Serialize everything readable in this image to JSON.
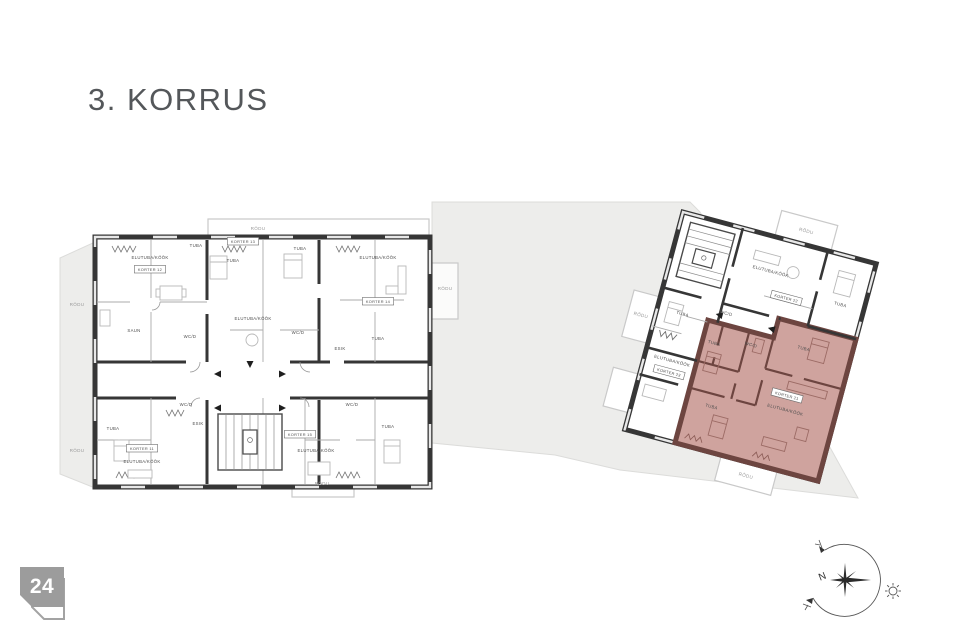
{
  "page": {
    "title": "3. KORRUS",
    "page_number": "24"
  },
  "legend": {
    "highlight_color": "#cb9b96",
    "highlight_wall": "#6d4540",
    "wall_color": "#363636",
    "site_color": "#ededeb",
    "badge_color": "#9c9c9c"
  },
  "left_building": {
    "labels": [
      {
        "t": "RÕDU",
        "x": 258,
        "y": 230,
        "s": "muted"
      },
      {
        "t": "RÕDU",
        "x": 77,
        "y": 306,
        "s": "muted"
      },
      {
        "t": "RÕDU",
        "x": 77,
        "y": 452,
        "s": "muted"
      },
      {
        "t": "RÕDU",
        "x": 445,
        "y": 290,
        "s": "muted"
      },
      {
        "t": "RÕDU",
        "x": 322,
        "y": 485,
        "s": "muted"
      },
      {
        "t": "ELUTUBA/KÖÖK",
        "x": 150,
        "y": 259,
        "s": "room"
      },
      {
        "t": "KORTER 12",
        "x": 150,
        "y": 271,
        "s": "unit"
      },
      {
        "t": "TUBA",
        "x": 196,
        "y": 247,
        "s": "room"
      },
      {
        "t": "TUBA",
        "x": 233,
        "y": 262,
        "s": "room"
      },
      {
        "t": "KORTER 13",
        "x": 243,
        "y": 243,
        "s": "unit"
      },
      {
        "t": "TUBA",
        "x": 300,
        "y": 250,
        "s": "room"
      },
      {
        "t": "ELUTUBA/KÖÖK",
        "x": 378,
        "y": 259,
        "s": "room"
      },
      {
        "t": "KORTER 14",
        "x": 378,
        "y": 303,
        "s": "unit"
      },
      {
        "t": "SAUN",
        "x": 134,
        "y": 332,
        "s": "room"
      },
      {
        "t": "WC/D",
        "x": 190,
        "y": 338,
        "s": "room"
      },
      {
        "t": "ELUTUBA/KÖÖK",
        "x": 253,
        "y": 320,
        "s": "room"
      },
      {
        "t": "WC/D",
        "x": 298,
        "y": 334,
        "s": "room"
      },
      {
        "t": "ESIK",
        "x": 340,
        "y": 350,
        "s": "room"
      },
      {
        "t": "TUBA",
        "x": 378,
        "y": 340,
        "s": "room"
      },
      {
        "t": "TUBA",
        "x": 113,
        "y": 430,
        "s": "room"
      },
      {
        "t": "KORTER 11",
        "x": 142,
        "y": 450,
        "s": "unit"
      },
      {
        "t": "ELUTUBA/KÖÖK",
        "x": 142,
        "y": 463,
        "s": "room"
      },
      {
        "t": "WC/D",
        "x": 186,
        "y": 406,
        "s": "room"
      },
      {
        "t": "ESIK",
        "x": 198,
        "y": 425,
        "s": "room"
      },
      {
        "t": "KORTER 15",
        "x": 300,
        "y": 436,
        "s": "unit"
      },
      {
        "t": "ELUTUBA/KÖÖK",
        "x": 316,
        "y": 452,
        "s": "room"
      },
      {
        "t": "WC/D",
        "x": 352,
        "y": 406,
        "s": "room"
      },
      {
        "t": "TUBA",
        "x": 388,
        "y": 428,
        "s": "room"
      }
    ]
  },
  "right_building": {
    "rotation_deg": 15,
    "labels": [
      {
        "t": "RÕDU",
        "x": 124,
        "y": -12,
        "s": "muted"
      },
      {
        "t": "RÕDU",
        "x": 129,
        "y": 240,
        "s": "muted"
      },
      {
        "t": "RÕDU",
        "x": -14,
        "y": 112,
        "s": "muted"
      },
      {
        "t": "ELUTUBA/KÖÖK",
        "x": 100,
        "y": 36,
        "s": "room"
      },
      {
        "t": "KORTER 22",
        "x": 122,
        "y": 58,
        "s": "unit"
      },
      {
        "t": "TUBA",
        "x": 176,
        "y": 50,
        "s": "room"
      },
      {
        "t": "TUBA",
        "x": 26,
        "y": 100,
        "s": "room"
      },
      {
        "t": "WC/D",
        "x": 68,
        "y": 88,
        "s": "room"
      },
      {
        "t": "ELUTUBA/KÖÖK",
        "x": 28,
        "y": 148,
        "s": "room"
      },
      {
        "t": "KORTER 23",
        "x": 28,
        "y": 160,
        "s": "unit"
      },
      {
        "t": "TUBA",
        "x": 64,
        "y": 120,
        "s": "room"
      },
      {
        "t": "WC/D",
        "x": 100,
        "y": 112,
        "s": "room"
      },
      {
        "t": "TUBA",
        "x": 152,
        "y": 102,
        "s": "room"
      },
      {
        "t": "TUBA",
        "x": 78,
        "y": 182,
        "s": "room"
      },
      {
        "t": "KORTER 21",
        "x": 148,
        "y": 152,
        "s": "unit"
      },
      {
        "t": "ELUTUBA/KÖÖK",
        "x": 150,
        "y": 166,
        "s": "room"
      }
    ]
  },
  "compass": {
    "north": "N"
  }
}
